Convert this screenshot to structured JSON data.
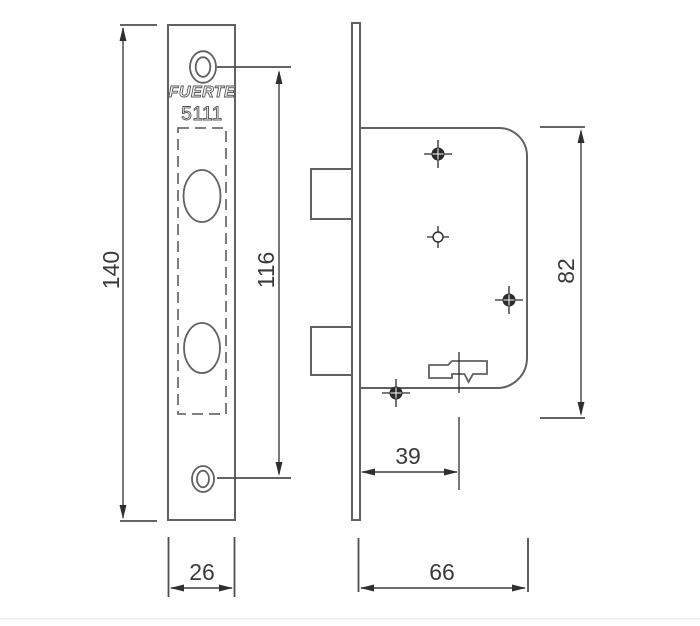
{
  "drawing": {
    "labels": {
      "brand": "FUERTE",
      "model": "5111"
    },
    "dims": {
      "front_height": "140",
      "hole_spacing": "116",
      "front_width": "26",
      "body_height": "82",
      "backset": "39",
      "body_depth": "66"
    },
    "colors": {
      "background": "#ffffff",
      "outline": "#616161",
      "dimension_line": "#3f3f3f",
      "text": "#3a3a3a",
      "marker": "#2b2b2b",
      "divider": "#ececec"
    }
  }
}
